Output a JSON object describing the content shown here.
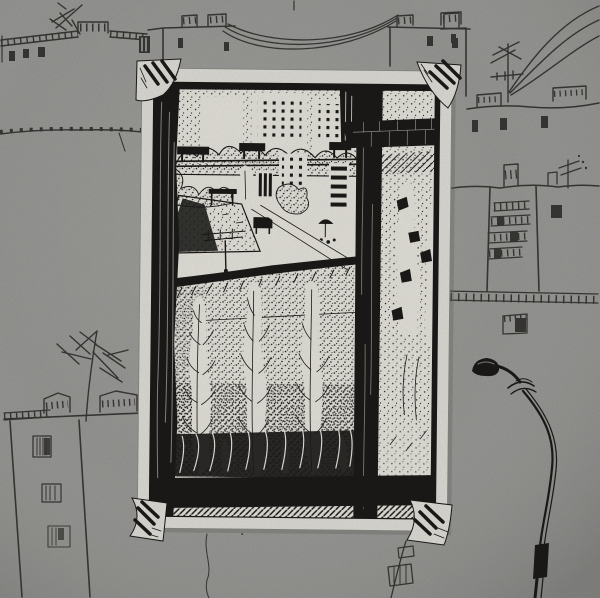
{
  "artwork": {
    "alt": "Black pen-and-ink drawing of a courtyard with tall poplar trees, tower blocks and a flat-roofed pavilion seen through a dark window frame; the drawing is mounted like a photograph with four striped paper corner tabs on a gray album page covered with loose felt-pen sketches of apartment rooftops, chimneys, TV antennas, sagging power lines, balconies and a curved street lamp.",
    "photo_title": "window-view-ink-drawing",
    "colors": {
      "background": "#a1a19e",
      "sketch": "#3c3b38",
      "ink": "#1d1c1a",
      "paper": "#eceae3",
      "drawing_paper": "#f2f0e8"
    },
    "page_sketch": {
      "items": [
        {
          "label": "rooftop-with-balcony-rail-top-left"
        },
        {
          "label": "tv-antenna-top-left"
        },
        {
          "label": "two-rooftops-with-sagging-power-lines-top-center"
        },
        {
          "label": "power-lines-and-antenna-top-right"
        },
        {
          "label": "apartment-block-with-balconies-right"
        },
        {
          "label": "ledge-line-left"
        },
        {
          "label": "apartment-block-with-big-antenna-bottom-left"
        },
        {
          "label": "curved-street-lamp-bottom-right"
        },
        {
          "label": "hanging-wire-below-photo"
        },
        {
          "label": "balcony-bricks-below-photo-right"
        }
      ]
    },
    "photo_scene": {
      "elements": [
        {
          "label": "dark-window-jamb-left"
        },
        {
          "label": "window-mullion-and-transom-right"
        },
        {
          "label": "stippled-sky"
        },
        {
          "label": "white-tower-blocks-with-dotted-windows"
        },
        {
          "label": "bushes-row-and-wall-with-chimneys"
        },
        {
          "label": "flat-roof-pavilion-with-drying-rack"
        },
        {
          "label": "kiosk-and-umbrella"
        },
        {
          "label": "white-footpath"
        },
        {
          "label": "tall-feathery-poplar-trees"
        },
        {
          "label": "dark-hedge-and-window-sill"
        }
      ],
      "corner_mounts": 4
    }
  }
}
